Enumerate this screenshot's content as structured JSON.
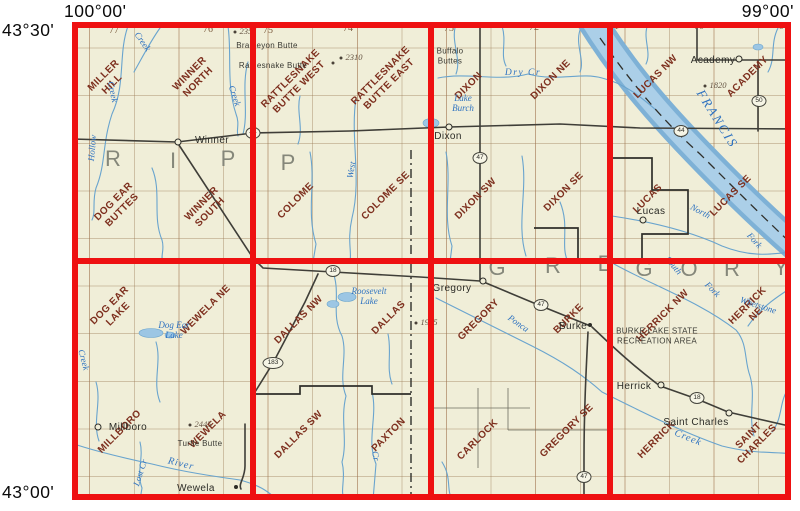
{
  "frame": {
    "lon_left": "100°00'",
    "lon_right": "99°00'",
    "lat_top": "43°30'",
    "lat_bottom": "43°00'"
  },
  "colors": {
    "index_grid_red": "#ee1111",
    "map_paper_cream": "#f0eed8",
    "quad_name_brown": "#7d2f1e",
    "water_blue": "#69a4ce",
    "county_gray": "#85877a"
  },
  "quads": [
    {
      "text": "MILLER\nHILL",
      "x": 108,
      "y": 80
    },
    {
      "text": "WINNER\nNORTH",
      "x": 194,
      "y": 78
    },
    {
      "text": "RATTLESNAKE\nBUTTE WEST",
      "x": 295,
      "y": 83
    },
    {
      "text": "RATTLESNAKE\nBUTTE EAST",
      "x": 385,
      "y": 80
    },
    {
      "text": "DIXON",
      "x": 469,
      "y": 86
    },
    {
      "text": "DIXON NE",
      "x": 551,
      "y": 80
    },
    {
      "text": "LUCAS NW",
      "x": 656,
      "y": 77
    },
    {
      "text": "ACADEMY",
      "x": 748,
      "y": 77
    },
    {
      "text": "DOG EAR\nBUTTES",
      "x": 118,
      "y": 206
    },
    {
      "text": "WINNER\nSOUTH",
      "x": 206,
      "y": 208
    },
    {
      "text": "COLOME",
      "x": 296,
      "y": 201
    },
    {
      "text": "COLOME SE",
      "x": 386,
      "y": 196
    },
    {
      "text": "DIXON SW",
      "x": 476,
      "y": 199
    },
    {
      "text": "DIXON SE",
      "x": 564,
      "y": 192
    },
    {
      "text": "LUCAS",
      "x": 648,
      "y": 199
    },
    {
      "text": "LUCAS SE",
      "x": 731,
      "y": 196
    },
    {
      "text": "DOG EAR\nLAKE",
      "x": 114,
      "y": 310
    },
    {
      "text": "WEWELA NE",
      "x": 206,
      "y": 310
    },
    {
      "text": "DALLAS NW",
      "x": 299,
      "y": 320
    },
    {
      "text": "DALLAS",
      "x": 389,
      "y": 318
    },
    {
      "text": "GREGORY",
      "x": 479,
      "y": 320
    },
    {
      "text": "BURKE",
      "x": 569,
      "y": 319
    },
    {
      "text": "HERRICK NW",
      "x": 663,
      "y": 316
    },
    {
      "text": "HERRICK NE",
      "x": 752,
      "y": 310
    },
    {
      "text": "MILLBORO",
      "x": 120,
      "y": 432
    },
    {
      "text": "WEWELA",
      "x": 208,
      "y": 430
    },
    {
      "text": "DALLAS SW",
      "x": 299,
      "y": 435
    },
    {
      "text": "PAXTON",
      "x": 389,
      "y": 435
    },
    {
      "text": "CARLOCK",
      "x": 478,
      "y": 440
    },
    {
      "text": "GREGORY SE",
      "x": 567,
      "y": 431
    },
    {
      "text": "HERRICK",
      "x": 657,
      "y": 440
    },
    {
      "text": "SAINT\nCHARLES",
      "x": 753,
      "y": 440
    }
  ],
  "counties": [
    {
      "name": "TRIPP",
      "letters": [
        {
          "ch": "R",
          "x": 113,
          "y": 159
        },
        {
          "ch": "I",
          "x": 173,
          "y": 161
        },
        {
          "ch": "P",
          "x": 228,
          "y": 159
        },
        {
          "ch": "P",
          "x": 288,
          "y": 163
        }
      ]
    },
    {
      "name": "GREGORY",
      "letters": [
        {
          "ch": "G",
          "x": 497,
          "y": 268
        },
        {
          "ch": "R",
          "x": 553,
          "y": 266
        },
        {
          "ch": "E",
          "x": 605,
          "y": 264
        },
        {
          "ch": "G",
          "x": 644,
          "y": 269
        },
        {
          "ch": "O",
          "x": 689,
          "y": 269
        },
        {
          "ch": "R",
          "x": 732,
          "y": 269
        },
        {
          "ch": "Y",
          "x": 781,
          "y": 268
        }
      ]
    }
  ],
  "towns": [
    {
      "name": "Winner",
      "x": 212,
      "y": 141,
      "marker": {
        "type": "ring",
        "x": 178,
        "y": 142
      }
    },
    {
      "name": "Dixon",
      "x": 448,
      "y": 137,
      "marker": {
        "type": "ring",
        "x": 449,
        "y": 127
      }
    },
    {
      "name": "Academy",
      "x": 713,
      "y": 61,
      "marker": {
        "type": "ring",
        "x": 739,
        "y": 59
      }
    },
    {
      "name": "Lucas",
      "x": 651,
      "y": 212,
      "marker": {
        "type": "ring",
        "x": 643,
        "y": 220
      }
    },
    {
      "name": "Gregory",
      "x": 452,
      "y": 289,
      "marker": {
        "type": "ring",
        "x": 483,
        "y": 281
      }
    },
    {
      "name": "Burke",
      "x": 573,
      "y": 327,
      "marker": {
        "type": "dot",
        "x": 590,
        "y": 325
      }
    },
    {
      "name": "Herrick",
      "x": 634,
      "y": 387,
      "marker": {
        "type": "ring",
        "x": 661,
        "y": 385
      }
    },
    {
      "name": "Saint Charles",
      "x": 696,
      "y": 423,
      "marker": {
        "type": "ring",
        "x": 729,
        "y": 413
      }
    },
    {
      "name": "Millboro",
      "x": 128,
      "y": 428,
      "marker": {
        "type": "ring",
        "x": 98,
        "y": 427
      }
    },
    {
      "name": "Wewela",
      "x": 196,
      "y": 489,
      "marker": {
        "type": "dot",
        "x": 236,
        "y": 487
      }
    }
  ],
  "features": [
    {
      "text": "Bradleyon Butte",
      "x": 267,
      "y": 46
    },
    {
      "text": "Rattlesnake Butte",
      "x": 273,
      "y": 66
    },
    {
      "text": "Buffalo\nButtes",
      "x": 450,
      "y": 56
    },
    {
      "text": "Turtle Butte",
      "x": 200,
      "y": 444
    },
    {
      "text": "BURKE LAKE STATE\nRECREATION AREA",
      "x": 657,
      "y": 336
    }
  ],
  "water_labels": [
    {
      "text": "Creek",
      "x": 142,
      "y": 42,
      "rot": 55
    },
    {
      "text": "Creek",
      "x": 112,
      "y": 92,
      "rot": 78
    },
    {
      "text": "Creek",
      "x": 234,
      "y": 96,
      "rot": 72
    },
    {
      "text": "Hollow",
      "x": 93,
      "y": 148,
      "rot": -85
    },
    {
      "text": "Dry Cr",
      "x": 523,
      "y": 73,
      "rot": 0,
      "size": 9.5,
      "ls": 1.5
    },
    {
      "text": "Lake\nBurch",
      "x": 463,
      "y": 104,
      "rot": 0
    },
    {
      "text": "FRANCIS",
      "x": 717,
      "y": 119,
      "rot": 58,
      "size": 13,
      "ls": 2
    },
    {
      "text": "North",
      "x": 700,
      "y": 212,
      "rot": 28
    },
    {
      "text": "Fork",
      "x": 754,
      "y": 241,
      "rot": 48
    },
    {
      "text": "West",
      "x": 352,
      "y": 170,
      "rot": -80
    },
    {
      "text": "Dog Ear\nLake",
      "x": 174,
      "y": 331,
      "rot": 0
    },
    {
      "text": "Roosevelt\nLake",
      "x": 369,
      "y": 297,
      "rot": 0
    },
    {
      "text": "Ponca",
      "x": 518,
      "y": 324,
      "rot": 35
    },
    {
      "text": "South",
      "x": 673,
      "y": 266,
      "rot": 50
    },
    {
      "text": "Fork",
      "x": 712,
      "y": 290,
      "rot": 45
    },
    {
      "text": "Whetstone",
      "x": 758,
      "y": 306,
      "rot": 18
    },
    {
      "text": "Creek",
      "x": 83,
      "y": 360,
      "rot": 75
    },
    {
      "text": "Lost Cr",
      "x": 141,
      "y": 473,
      "rot": -72
    },
    {
      "text": "River",
      "x": 181,
      "y": 464,
      "rot": 14,
      "size": 10,
      "ls": 1
    },
    {
      "text": "Creek",
      "x": 688,
      "y": 438,
      "rot": 22,
      "size": 10,
      "ls": 1
    },
    {
      "text": "Cr",
      "x": 375,
      "y": 456,
      "rot": 80
    }
  ],
  "township_numbers": [
    {
      "text": "77",
      "x": 114,
      "y": 31
    },
    {
      "text": "76",
      "x": 208,
      "y": 30
    },
    {
      "text": "75",
      "x": 268,
      "y": 31
    },
    {
      "text": "74",
      "x": 348,
      "y": 29
    },
    {
      "text": "73",
      "x": 449,
      "y": 29
    },
    {
      "text": "72",
      "x": 534,
      "y": 28
    },
    {
      "text": "71",
      "x": 614,
      "y": 27
    },
    {
      "text": "70",
      "x": 699,
      "y": 27
    },
    {
      "text": "6",
      "x": 781,
      "y": 27
    }
  ],
  "elevations": [
    {
      "text": "2355",
      "x": 248,
      "y": 31
    },
    {
      "text": "2310",
      "x": 354,
      "y": 57
    },
    {
      "text": "1820",
      "x": 718,
      "y": 85
    },
    {
      "text": "1955",
      "x": 429,
      "y": 322
    },
    {
      "text": "2445",
      "x": 203,
      "y": 424
    }
  ],
  "spot_dots": [
    {
      "x": 333,
      "y": 63
    },
    {
      "x": 431,
      "y": 50
    }
  ],
  "route_shields": [
    {
      "num": "44",
      "x": 253,
      "y": 133
    },
    {
      "num": "47",
      "x": 480,
      "y": 158
    },
    {
      "num": "44",
      "x": 681,
      "y": 131
    },
    {
      "num": "50",
      "x": 759,
      "y": 101
    },
    {
      "num": "18",
      "x": 333,
      "y": 271
    },
    {
      "num": "183",
      "x": 273,
      "y": 363
    },
    {
      "num": "47",
      "x": 541,
      "y": 305
    },
    {
      "num": "47",
      "x": 584,
      "y": 477
    },
    {
      "num": "18",
      "x": 697,
      "y": 398
    }
  ]
}
